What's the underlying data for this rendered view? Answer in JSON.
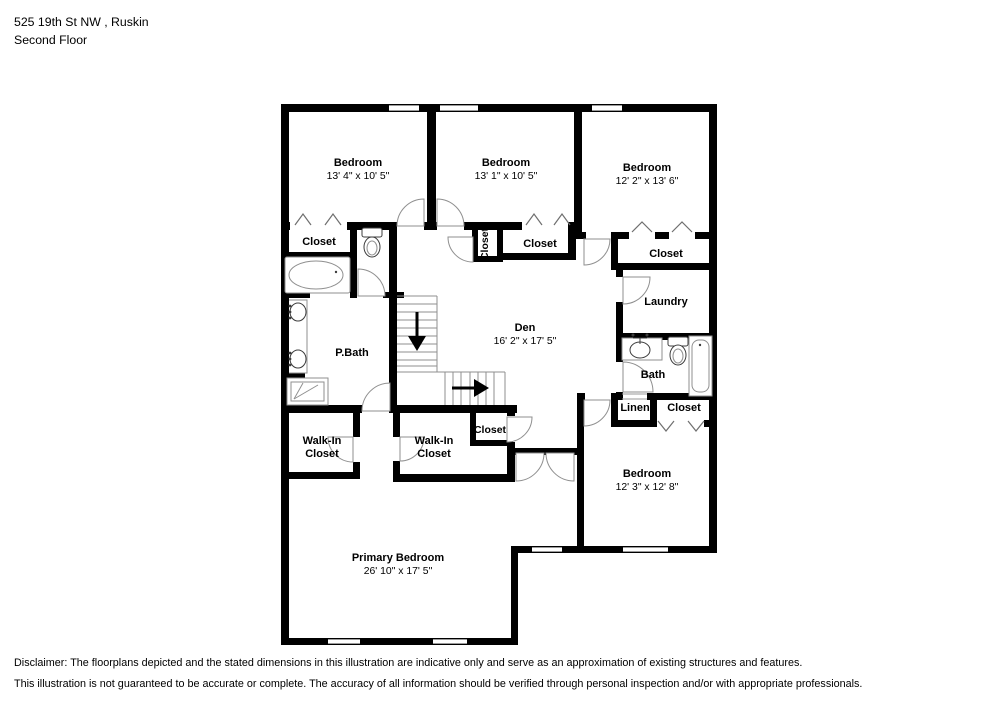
{
  "header": {
    "address": "525 19th St NW , Ruskin",
    "floor": "Second Floor"
  },
  "rooms": {
    "bedroom_top_left": {
      "name": "Bedroom",
      "dims": "13' 4\" x 10' 5\""
    },
    "bedroom_top_mid": {
      "name": "Bedroom",
      "dims": "13' 1\" x 10' 5\""
    },
    "bedroom_top_right": {
      "name": "Bedroom",
      "dims": "12' 2\" x 13' 6\""
    },
    "bedroom_right": {
      "name": "Bedroom",
      "dims": "12' 3\" x 12' 8\""
    },
    "primary_bedroom": {
      "name": "Primary Bedroom",
      "dims": "26' 10\" x 17' 5\""
    },
    "den": {
      "name": "Den",
      "dims": "16' 2\" x 17' 5\""
    },
    "pbath": {
      "name": "P.Bath"
    },
    "bath": {
      "name": "Bath"
    },
    "laundry": {
      "name": "Laundry"
    },
    "linen": {
      "name": "Linen"
    },
    "walk_in_closet_left": {
      "line1": "Walk-In",
      "line2": "Closet"
    },
    "walk_in_closet_mid": {
      "line1": "Walk-In",
      "line2": "Closet"
    },
    "closet_top_left": {
      "name": "Closet"
    },
    "closet_vertical": {
      "name": "Closet"
    },
    "closet_top_mid": {
      "name": "Closet"
    },
    "closet_top_right": {
      "name": "Closet"
    },
    "closet_hall": {
      "name": "Closet"
    },
    "closet_bedroom_right": {
      "name": "Closet"
    }
  },
  "disclaimer": {
    "line1": "Disclaimer: The floorplans depicted and the stated dimensions in this illustration are indicative only and serve as an approximation of existing structures and features.",
    "line2": "This illustration is not guaranteed to be accurate or complete. The accuracy of all information should be verified through personal inspection and/or with appropriate professionals."
  }
}
